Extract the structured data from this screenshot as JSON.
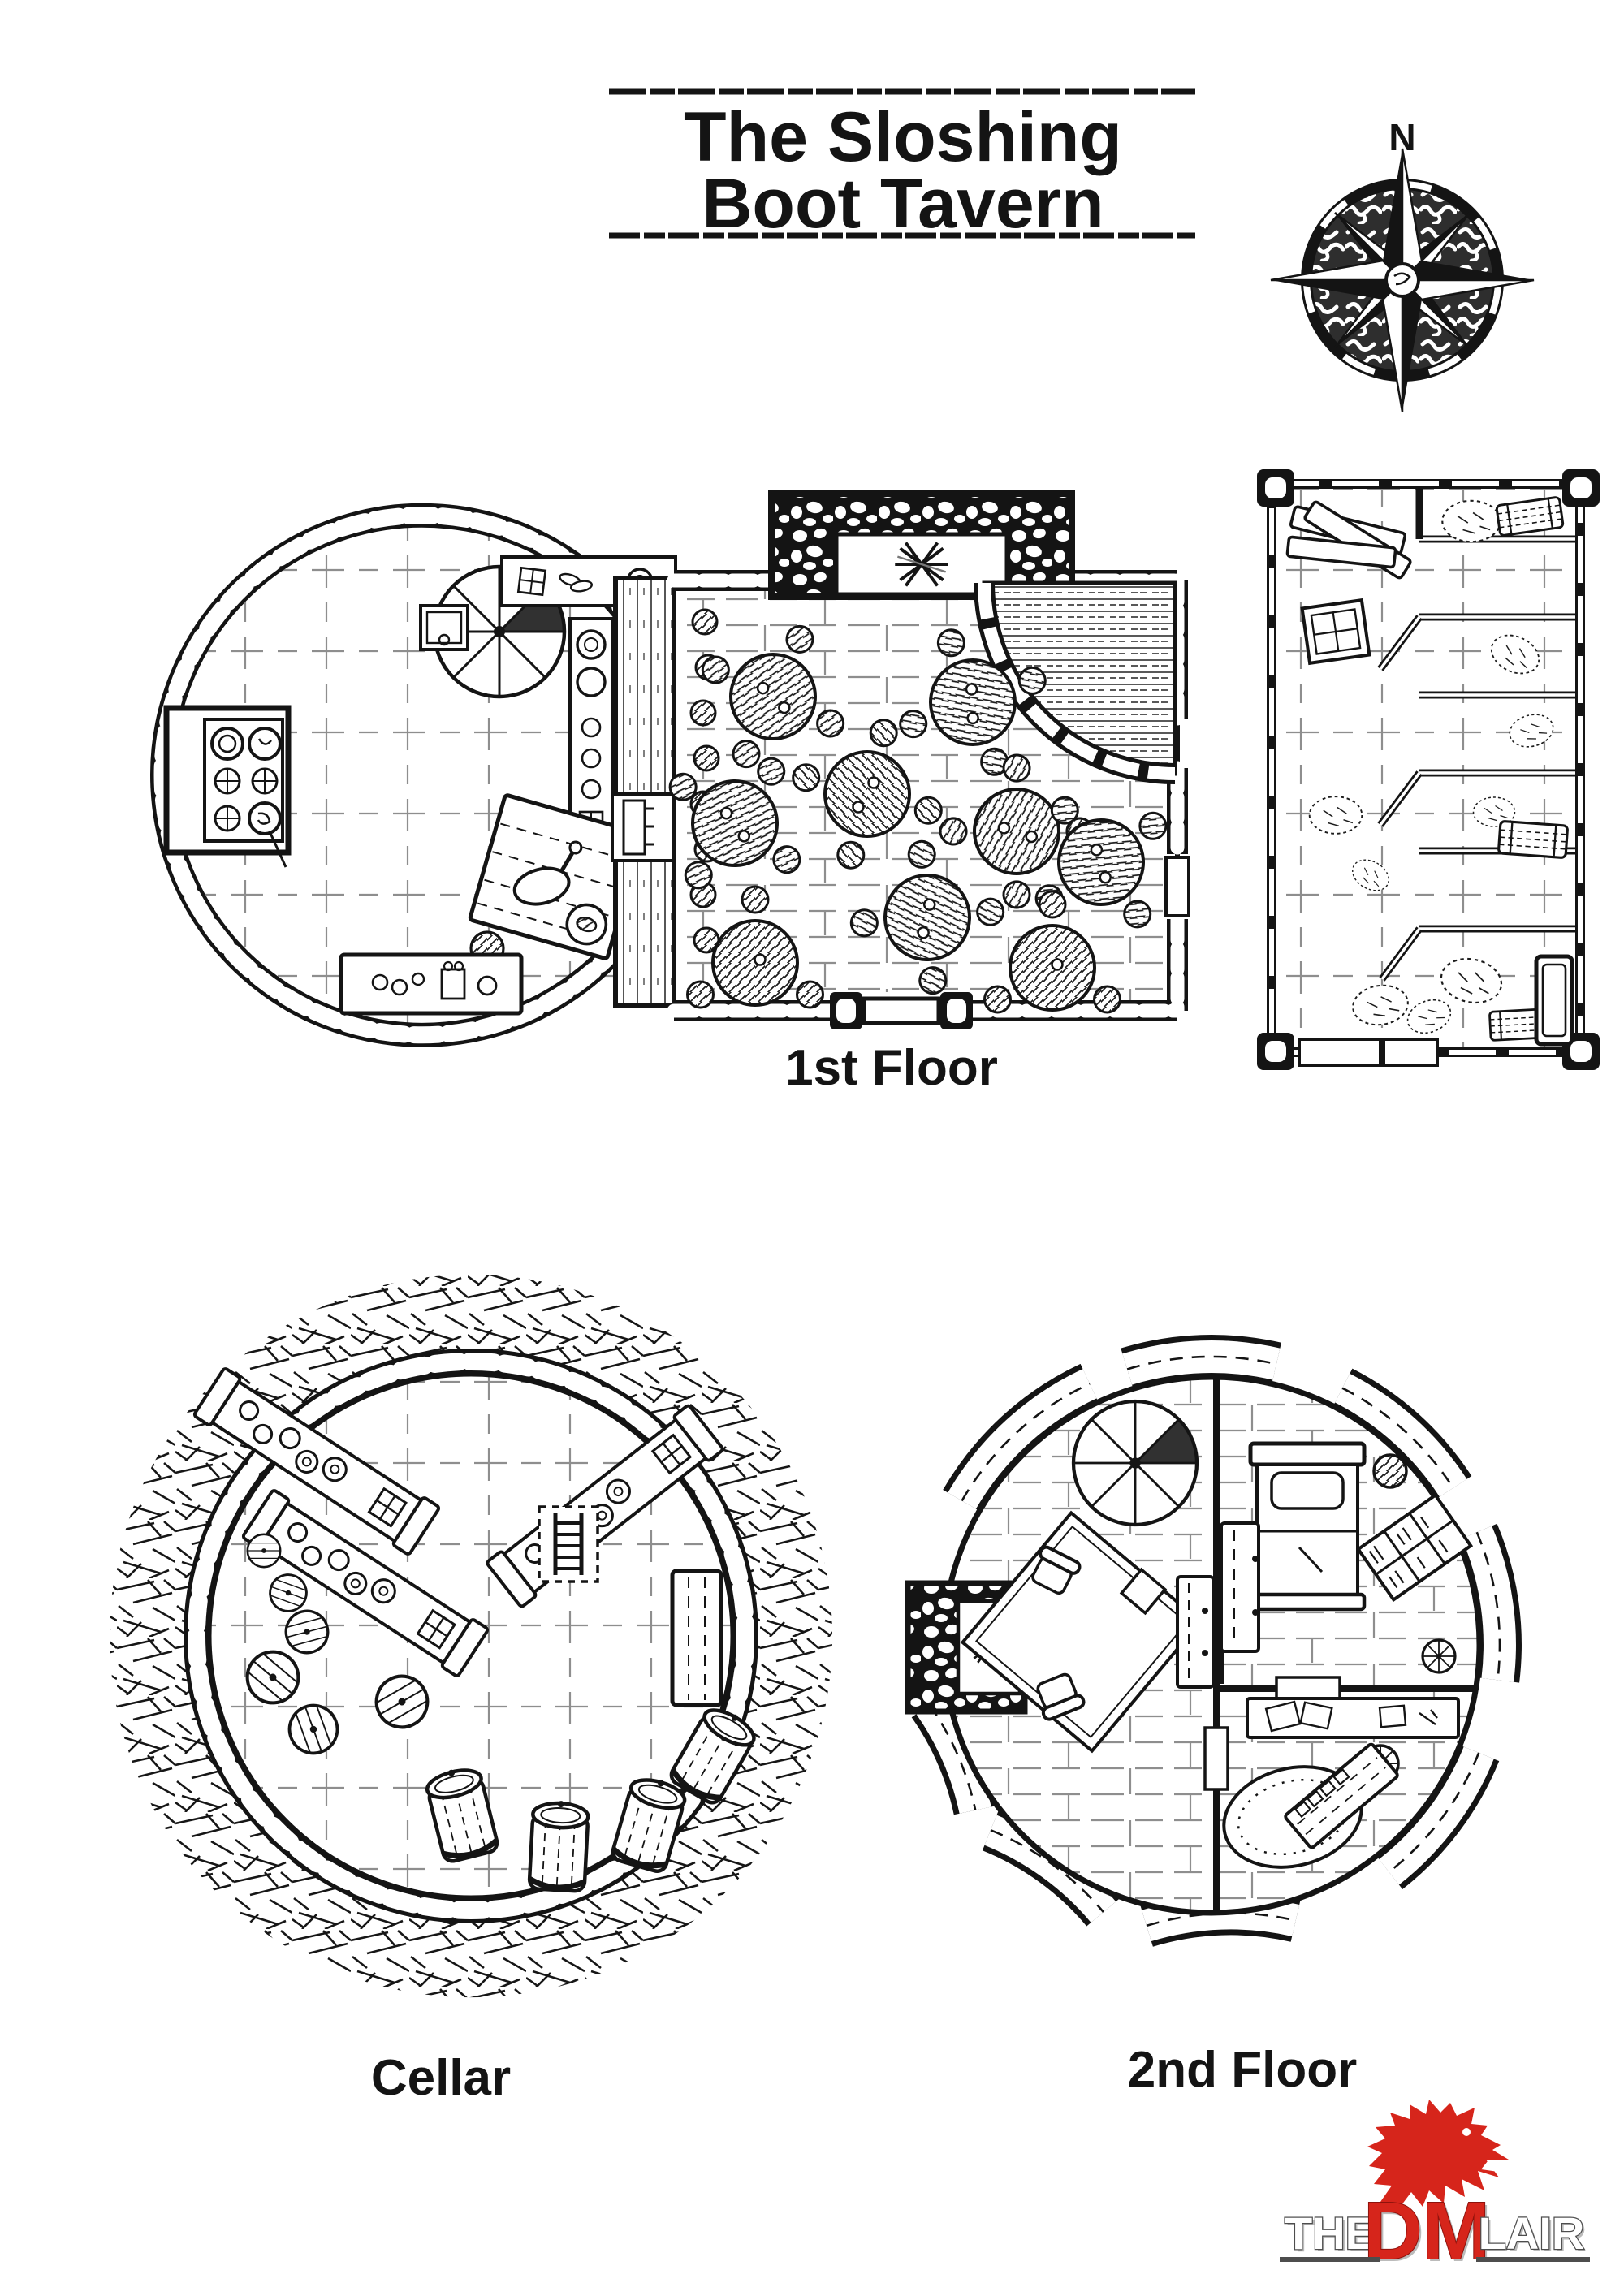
{
  "title": {
    "line1": "The Sloshing",
    "line2": "Boot Tavern"
  },
  "compass": {
    "north_label": "N"
  },
  "floors": {
    "first_label": "1st Floor",
    "cellar_label": "Cellar",
    "second_label": "2nd Floor"
  },
  "logo": {
    "word_the": "THE",
    "word_dm": "DM",
    "word_lair": "LAIR"
  },
  "colors": {
    "ink": "#141414",
    "floor_line": "#8e8e8e",
    "logo_red": "#d6251b",
    "logo_outline": "#4d4d4d"
  },
  "features": {
    "first_floor": [
      "spiral-staircase-icon",
      "kitchen-stove-icon",
      "cooking-pots-icon",
      "prep-table-icon",
      "cutting-board-icon",
      "kitchen-counter-icon",
      "storage-crate-icon",
      "fireplace-icon",
      "bar-counter-icon",
      "round-dining-table-icon",
      "stool-icon",
      "double-door-entrance-icon",
      "stable-stall-icon",
      "stall-gate-icon",
      "hay-pile-icon",
      "hay-bale-icon",
      "feed-trough-icon",
      "lumber-pile-icon"
    ],
    "cellar": [
      "wine-rack-icon",
      "bottle-icon",
      "ladder-icon",
      "small-cask-icon",
      "large-barrel-icon",
      "storage-table-icon",
      "stone-wall-icon",
      "earth-hatching-icon"
    ],
    "second_floor": [
      "spiral-staircase-icon",
      "fireplace-icon",
      "bed-icon",
      "pillow-icon",
      "dresser-icon",
      "bookshelf-icon",
      "armchair-icon",
      "area-rug-icon",
      "side-table-icon",
      "cabinet-icon",
      "writing-desk-icon",
      "desk-stool-icon",
      "oval-rug-icon",
      "workbench-icon",
      "wheel-stool-icon",
      "door-icon",
      "roof-beam-icon"
    ]
  }
}
